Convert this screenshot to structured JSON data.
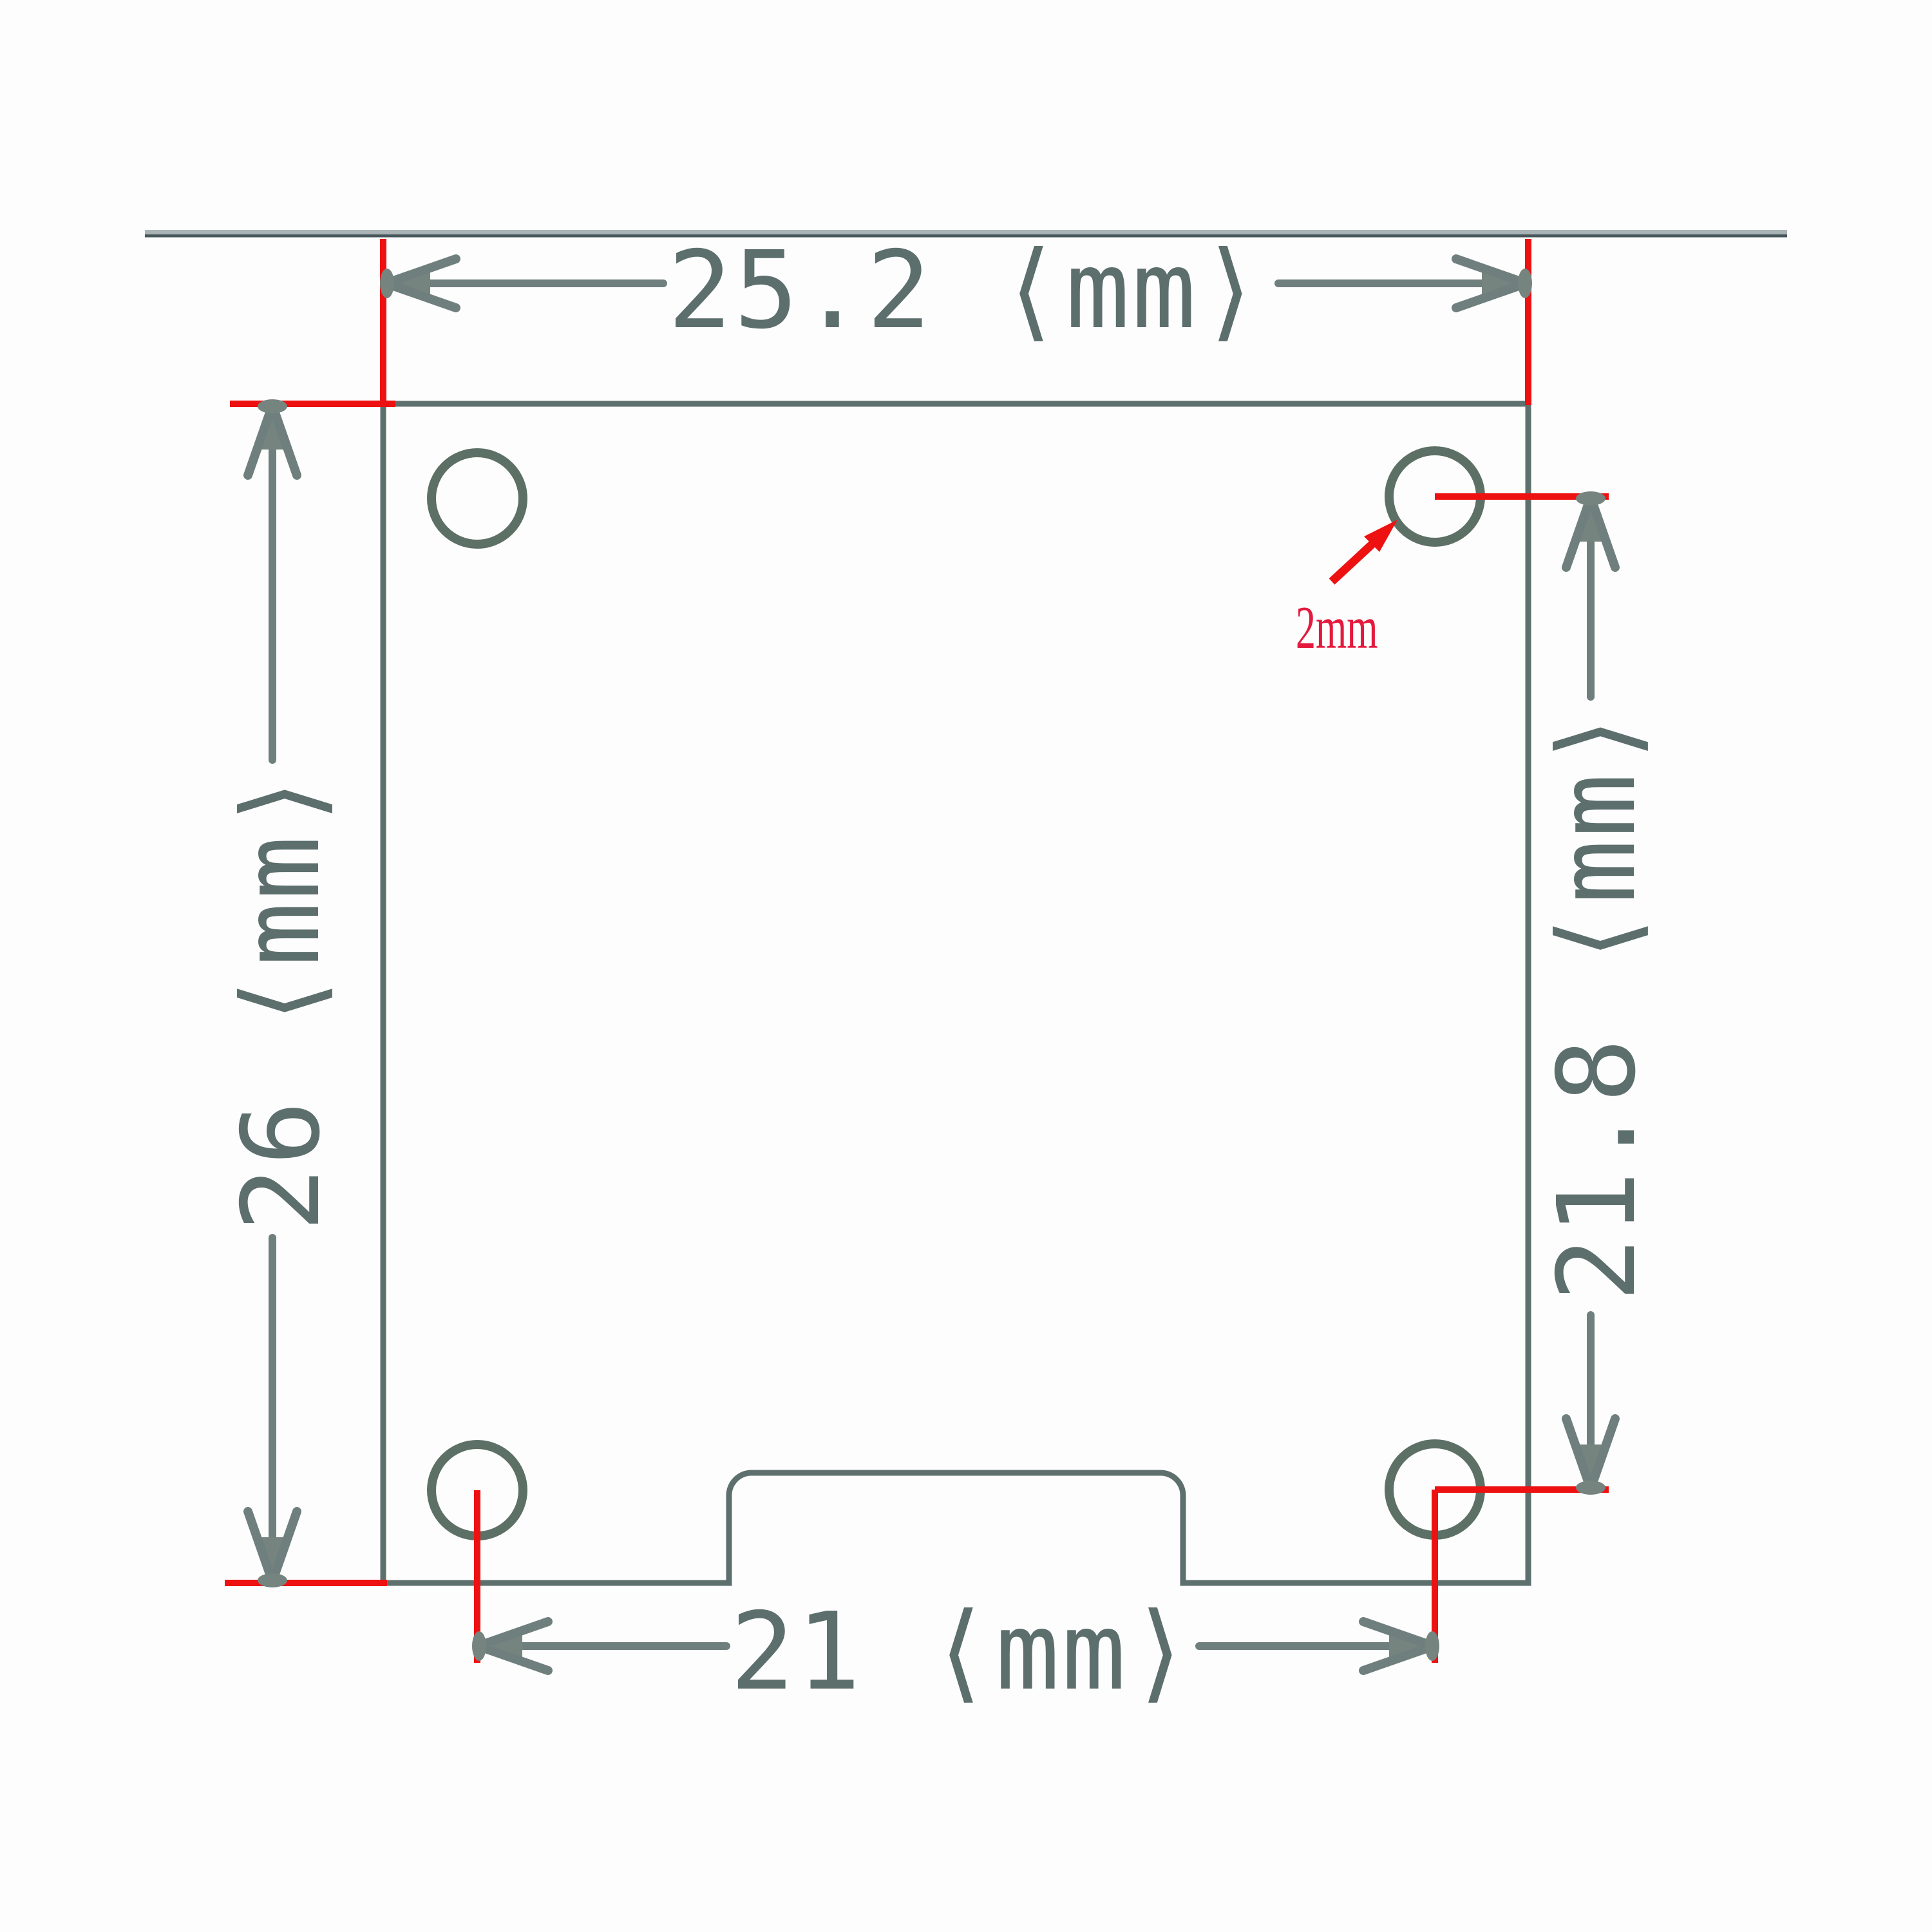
{
  "drawing": {
    "type": "mechanical-dimension-drawing",
    "subject": "PCB module outline with four mounting holes and bottom connector notch",
    "unit": "mm",
    "labels": {
      "board_width_top": "25.2 ⟨mm⟩",
      "board_height_left": "26 ⟨mm⟩",
      "hole_spacing_right": "21.8 ⟨mm⟩",
      "hole_spacing_bottom": "21 ⟨mm⟩",
      "hole_diameter": "2mm"
    },
    "values": {
      "board_width_mm": 25.2,
      "board_height_mm": 26,
      "hole_spacing_vertical_mm": 21.8,
      "hole_spacing_horizontal_mm": 21,
      "hole_diameter_mm": 2,
      "hole_count": 4
    },
    "colors": {
      "outline_gray": "#5e706e",
      "dimension_gray": "#6f7f7d",
      "text_gray": "#5c6f6d",
      "extension_red": "#ee1111",
      "annotation_red": "#e31a3d"
    }
  }
}
